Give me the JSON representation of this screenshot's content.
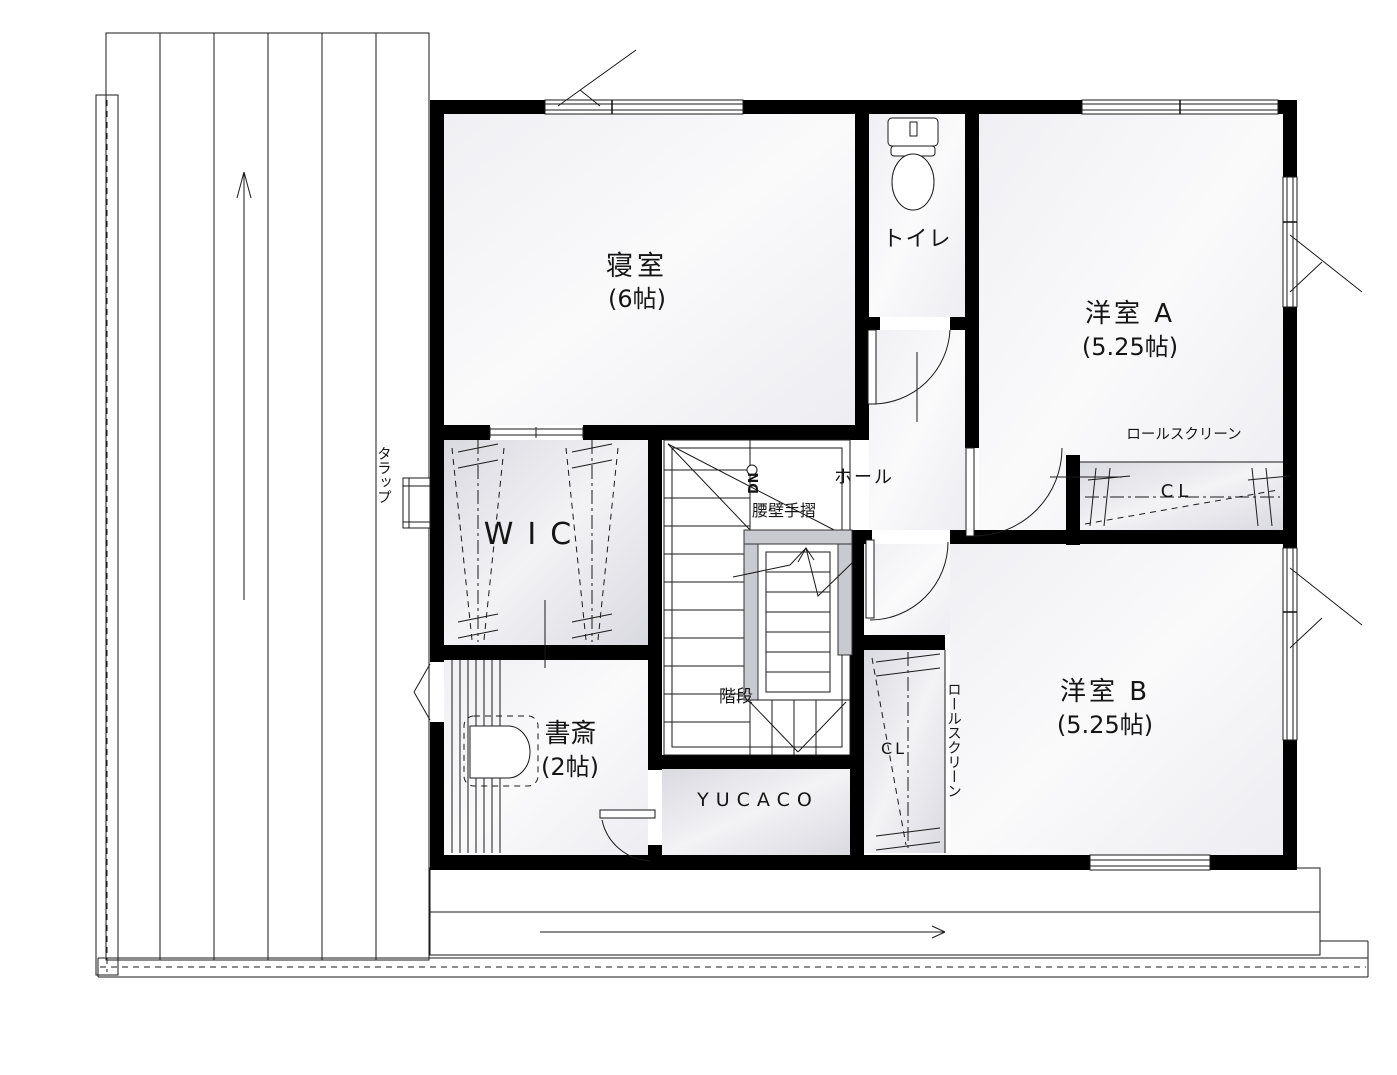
{
  "drawing": {
    "kind": "2F floor plan"
  },
  "rooms": {
    "bedroom": {
      "name": "寝室",
      "size": "(6帖)"
    },
    "toilet": {
      "name": "トイレ"
    },
    "western_a": {
      "name": "洋室 A",
      "size": "(5.25帖)"
    },
    "western_b": {
      "name": "洋室 B",
      "size": "(5.25帖)"
    },
    "wic": {
      "name": "WIC"
    },
    "study": {
      "name": "書斎",
      "size": "(2帖)"
    },
    "yucaco": {
      "name": "YUCACO"
    },
    "hall": {
      "name": "ホール"
    },
    "stairs": {
      "name": "階段"
    }
  },
  "annotations": {
    "handrail": "腰壁手摺",
    "down": "DN",
    "ladder": "タラップ",
    "roll_screen_a": "ロールスクリーン",
    "roll_screen_b": "ロールスクリーン",
    "closet_a": "CL",
    "closet_b": "CL"
  },
  "colors": {
    "wall": "#000000",
    "line": "#1a1a1a",
    "room_fill_light": "#f4f4f7",
    "closet_fill": "#e2e2e8",
    "waist_wall": "#c9c9d0"
  }
}
